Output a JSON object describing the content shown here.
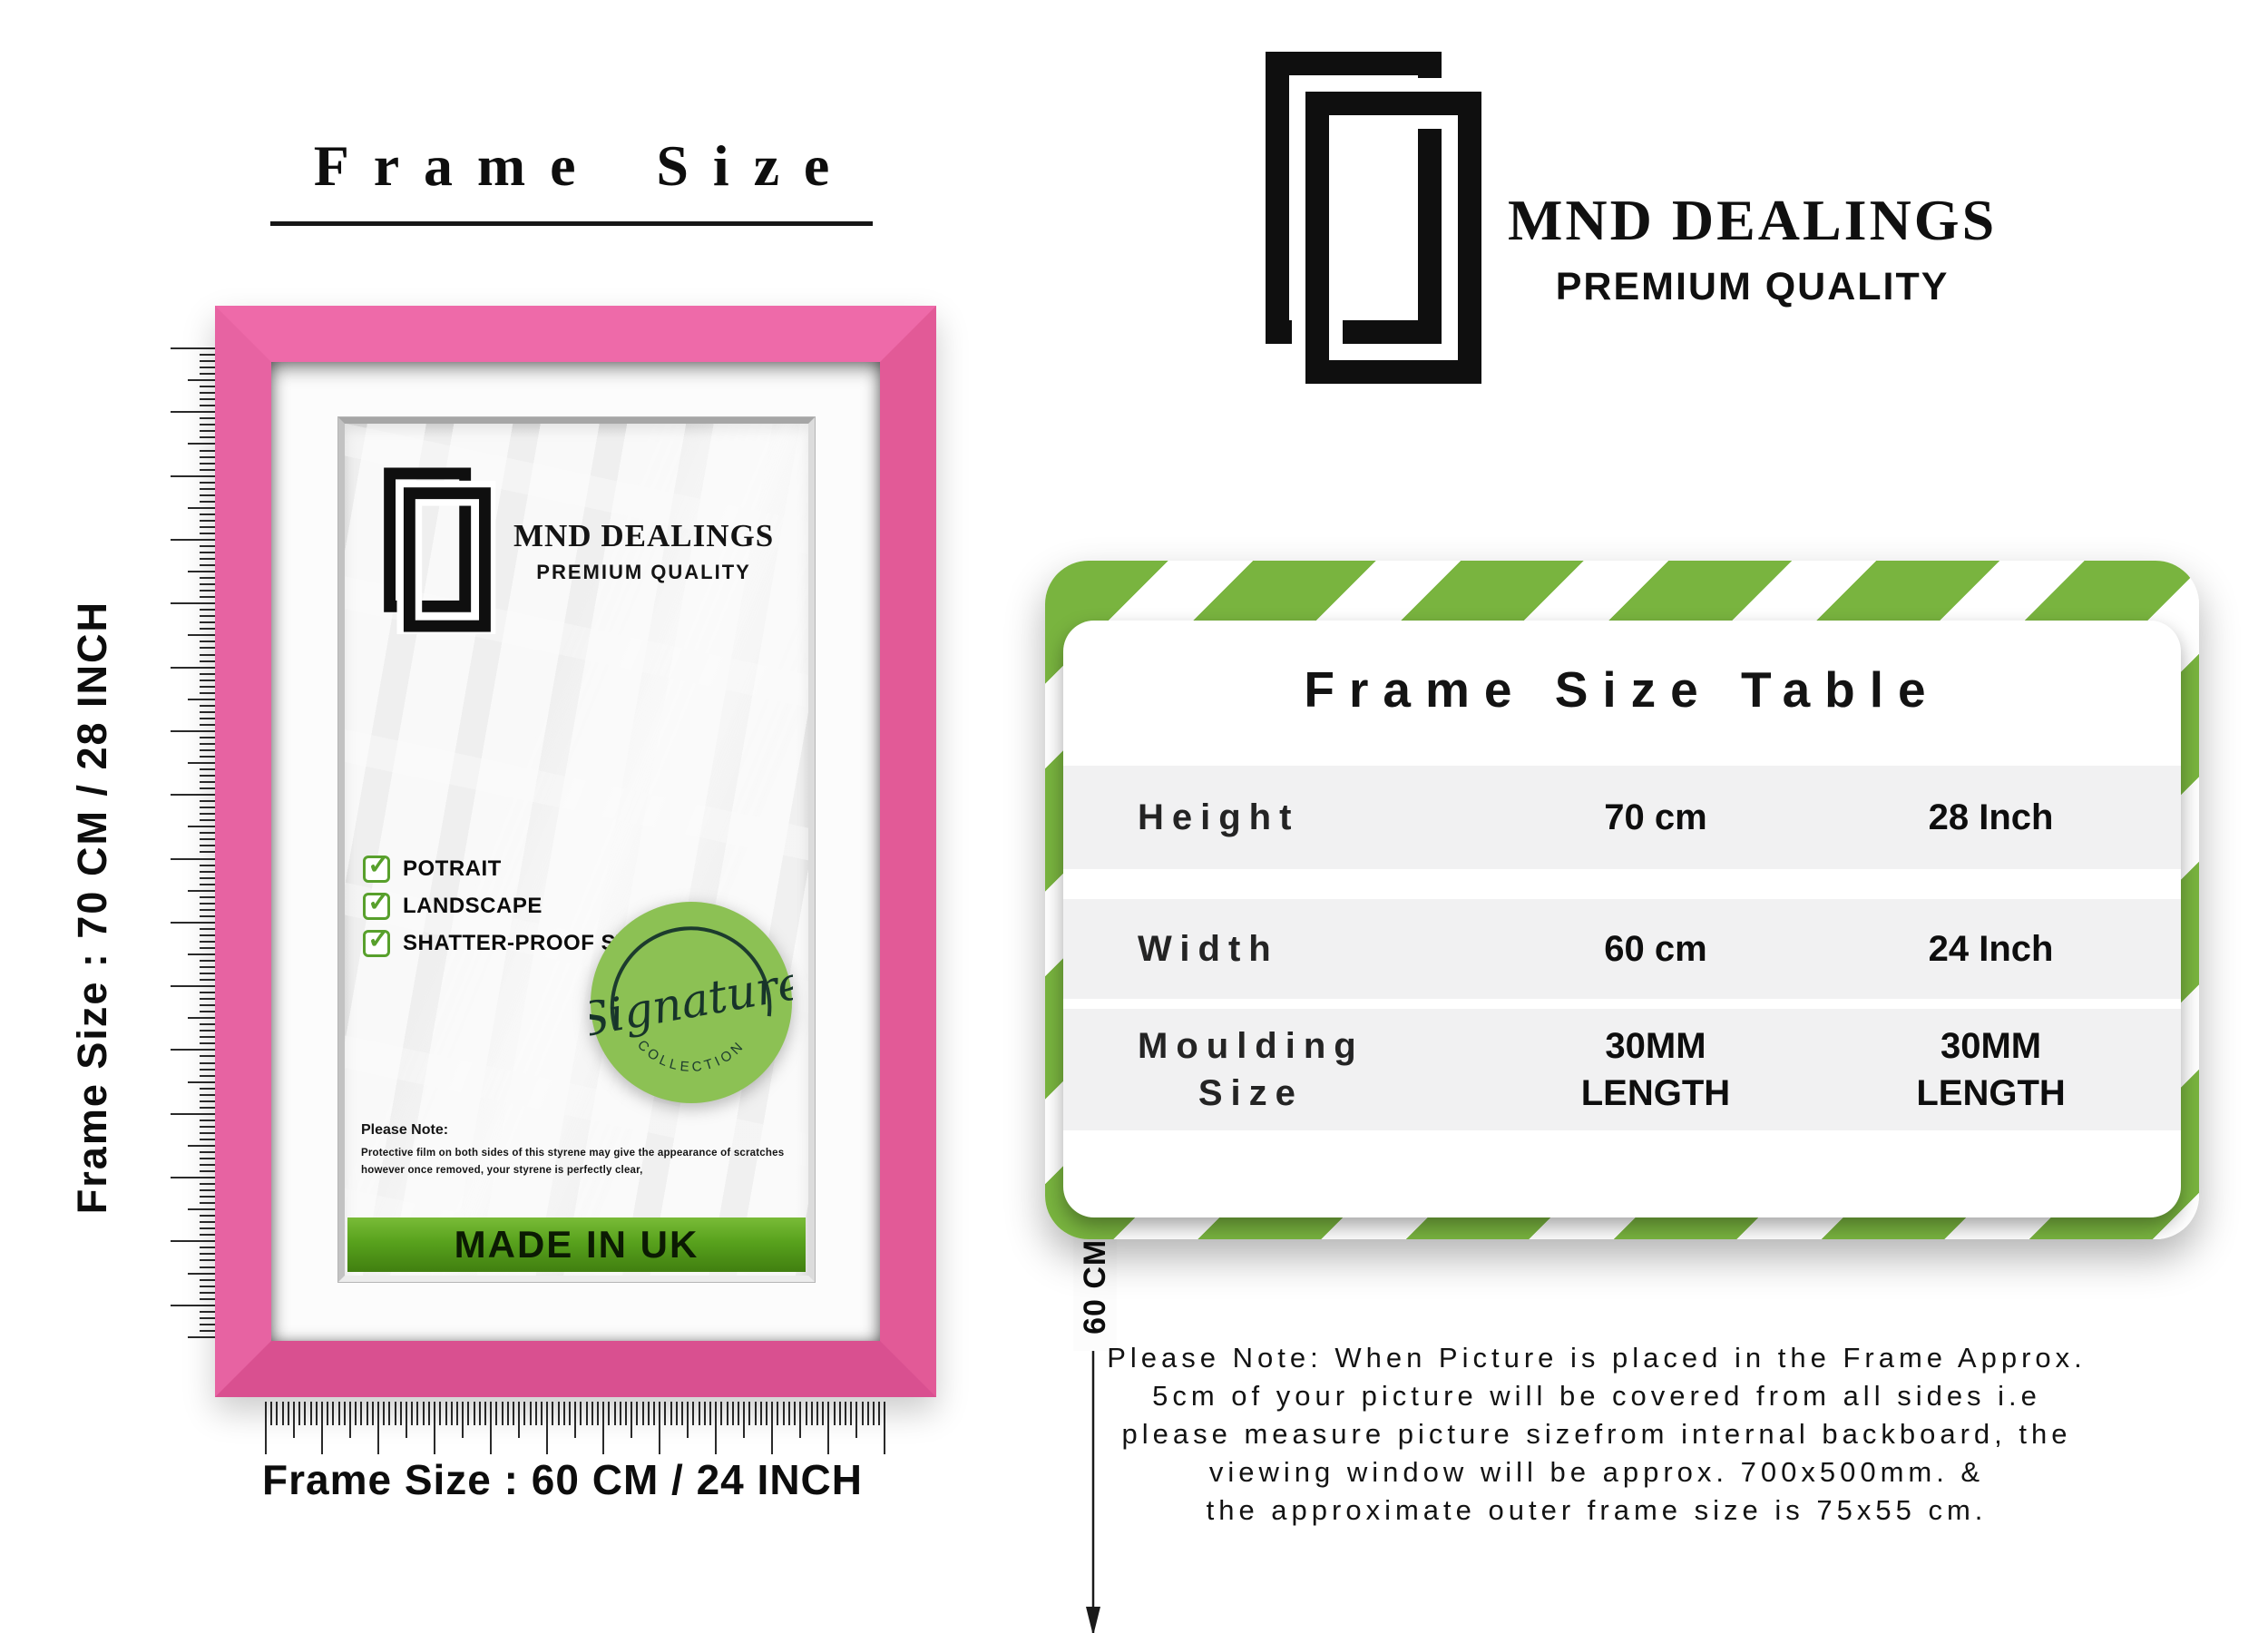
{
  "colors": {
    "frame_pink": "#e85d9c",
    "stripe_green": "#79b43f",
    "badge_green": "#8cc154",
    "banner_green": "#58a21d",
    "check_green": "#58a02c",
    "row_gray": "#f1f1f2"
  },
  "brand": {
    "name": "MND DEALINGS",
    "tagline": "PREMIUM QUALITY"
  },
  "left": {
    "heading": "Frame Size",
    "side_label": "Frame Size : 70 CM / 28 INCH",
    "bottom_label": "Frame Size : 60 CM / 24 INCH",
    "frame": {
      "features": [
        "POTRAIT",
        "LANDSCAPE",
        "SHATTER-PROOF STYRENE"
      ],
      "badge": {
        "script": "Signature",
        "arc": "COLLECTION"
      },
      "note_title": "Please Note:",
      "note_body": "Protective film on both sides of this styrene may give the appearance of scratches however once removed, your styrene is perfectly clear,",
      "made_in": "MADE IN UK",
      "width_dim": "50 CM / 20 INCH",
      "height_dim": "60 CM / 24 INCH"
    }
  },
  "right": {
    "table": {
      "title": "Frame Size Table",
      "rows": [
        {
          "label": "Height",
          "cm": "70 cm",
          "inch": "28 Inch"
        },
        {
          "label": "Width",
          "cm": "60 cm",
          "inch": "24 Inch"
        },
        {
          "label": "Moulding\nSize",
          "cm": "30MM\nLENGTH",
          "inch": "30MM\nLENGTH"
        }
      ]
    },
    "note_lines": [
      "Please Note: When Picture is placed in the Frame Approx.",
      "5cm of your picture will be covered from all sides i.e",
      "please measure picture sizefrom internal backboard, the",
      "viewing window will be approx. 700x500mm. &",
      "the approximate outer frame size is 75x55 cm."
    ]
  }
}
